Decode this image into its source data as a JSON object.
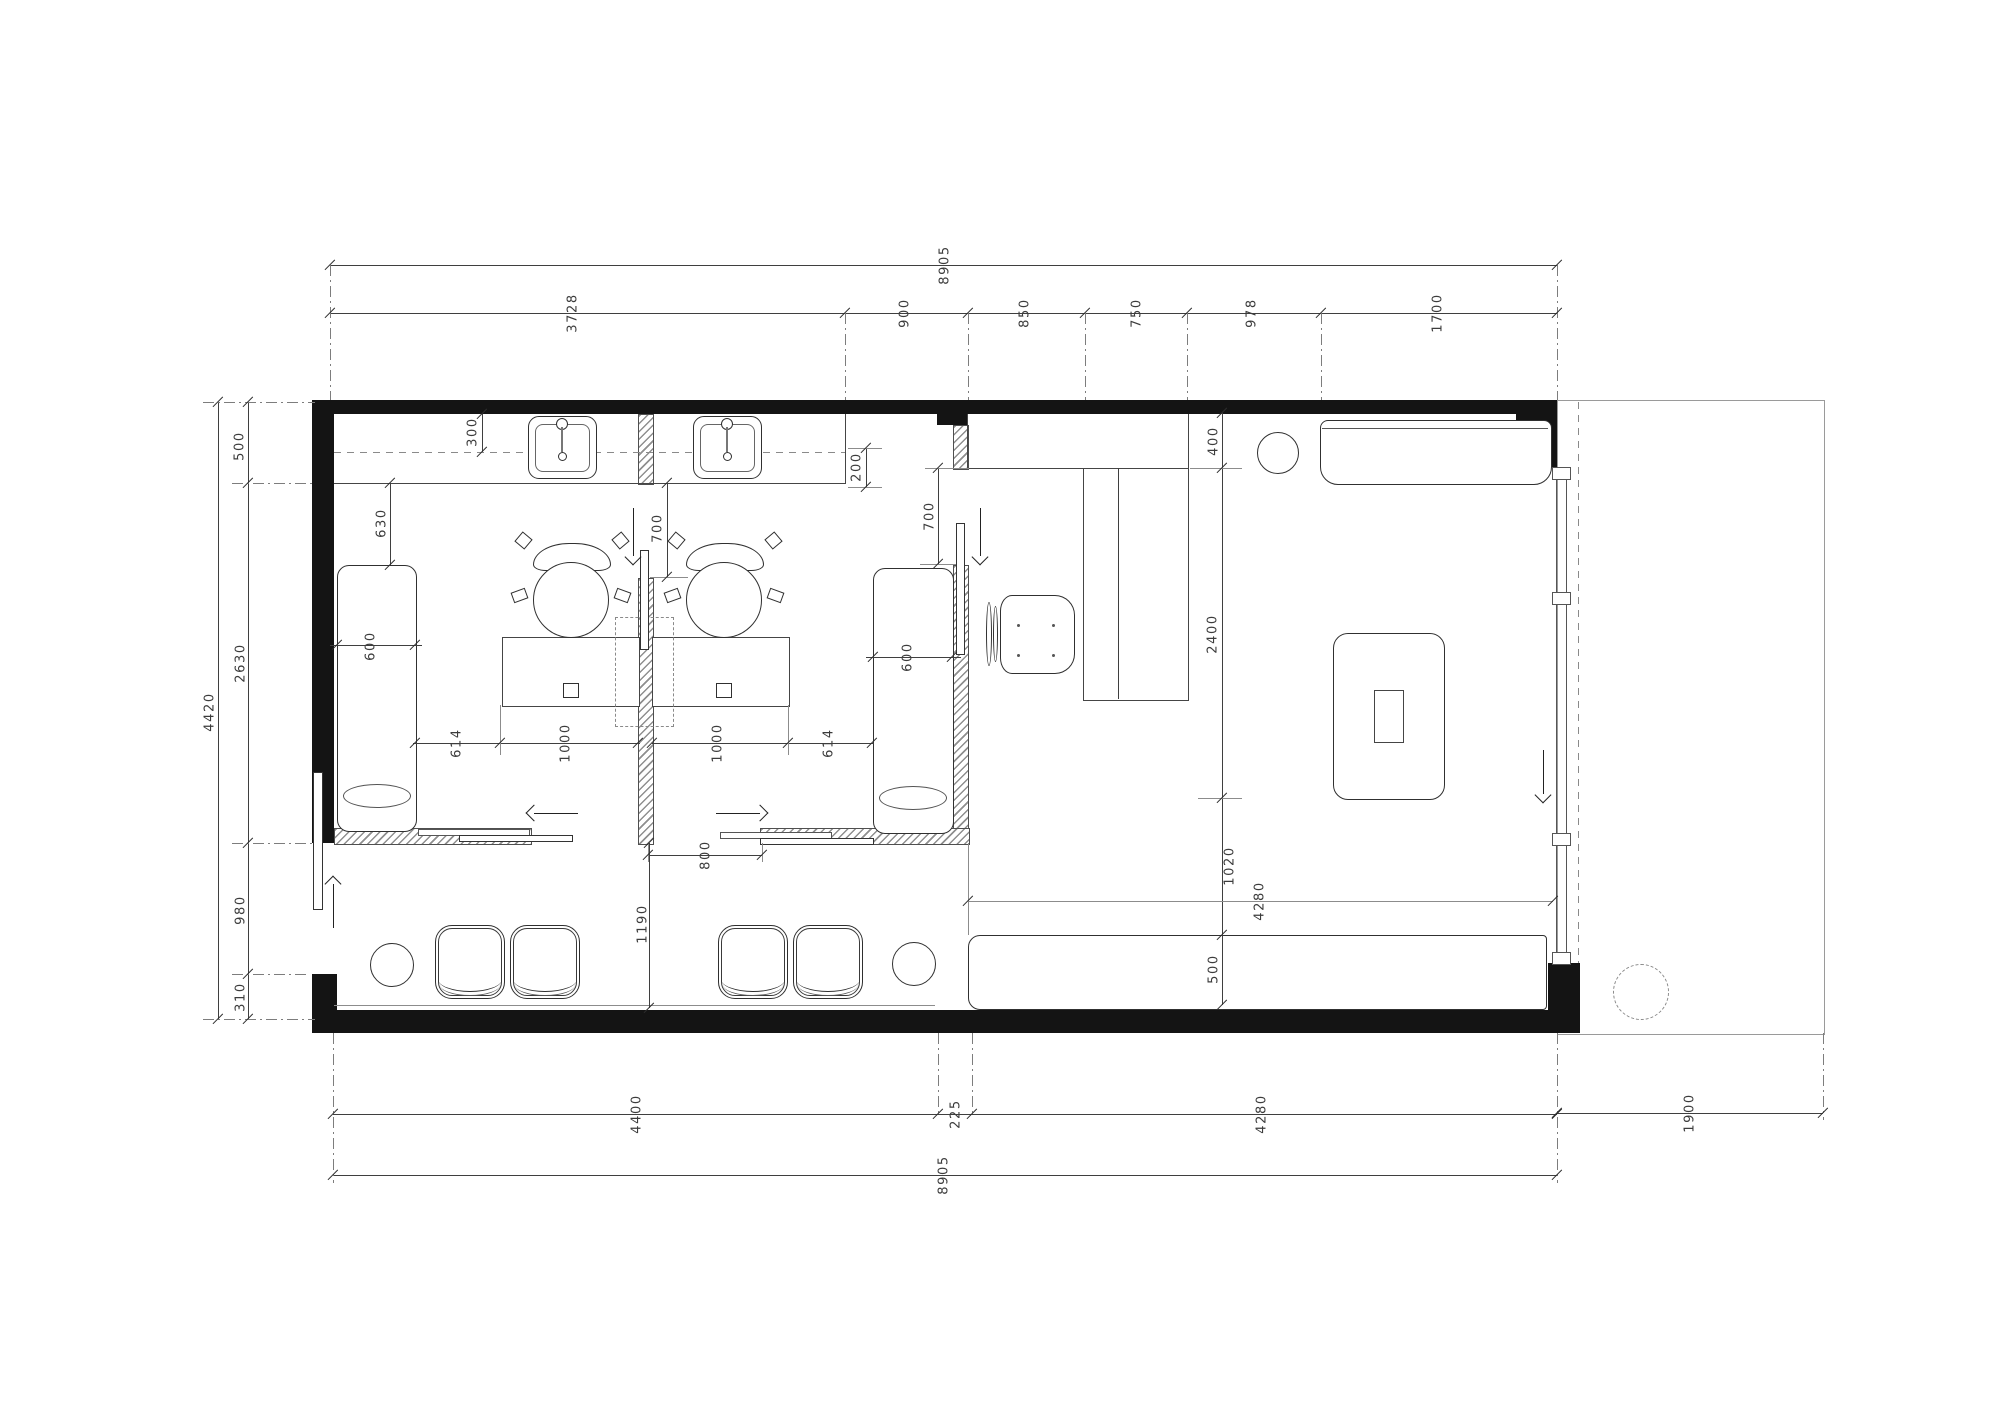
{
  "drawing": {
    "type": "architectural-floor-plan",
    "units": "mm",
    "colors": {
      "wall": "#141414",
      "line": "#3f3f3f",
      "hatch": "#8f8f8f"
    }
  },
  "dims": {
    "top_overall": "8905",
    "top_seg1": "3728",
    "top_seg2": "900",
    "top_seg3": "850",
    "top_seg4": "750",
    "top_seg5": "978",
    "top_seg6": "1700",
    "left_overall": "4420",
    "left_seg1": "500",
    "left_seg2": "2630",
    "left_seg3": "980",
    "left_seg4": "310",
    "right_seg1": "400",
    "right_seg2": "2400",
    "right_seg3": "1020",
    "right_seg4": "500",
    "bottom_seg1": "4400",
    "bottom_seg2": "225",
    "bottom_seg3": "4280",
    "bottom_overall": "8905",
    "bottom_right": "1900",
    "counter_depth": "300",
    "counter_end": "200",
    "bed1_offset": "630",
    "bed1_width": "600",
    "bed2_width": "600",
    "door1_opening": "700",
    "door2_opening": "700",
    "gap1": "614",
    "desk1_width": "1000",
    "desk2_width": "1000",
    "gap2": "614",
    "slide_door": "800",
    "waiting_depth": "1190",
    "hall_width": "4280"
  }
}
